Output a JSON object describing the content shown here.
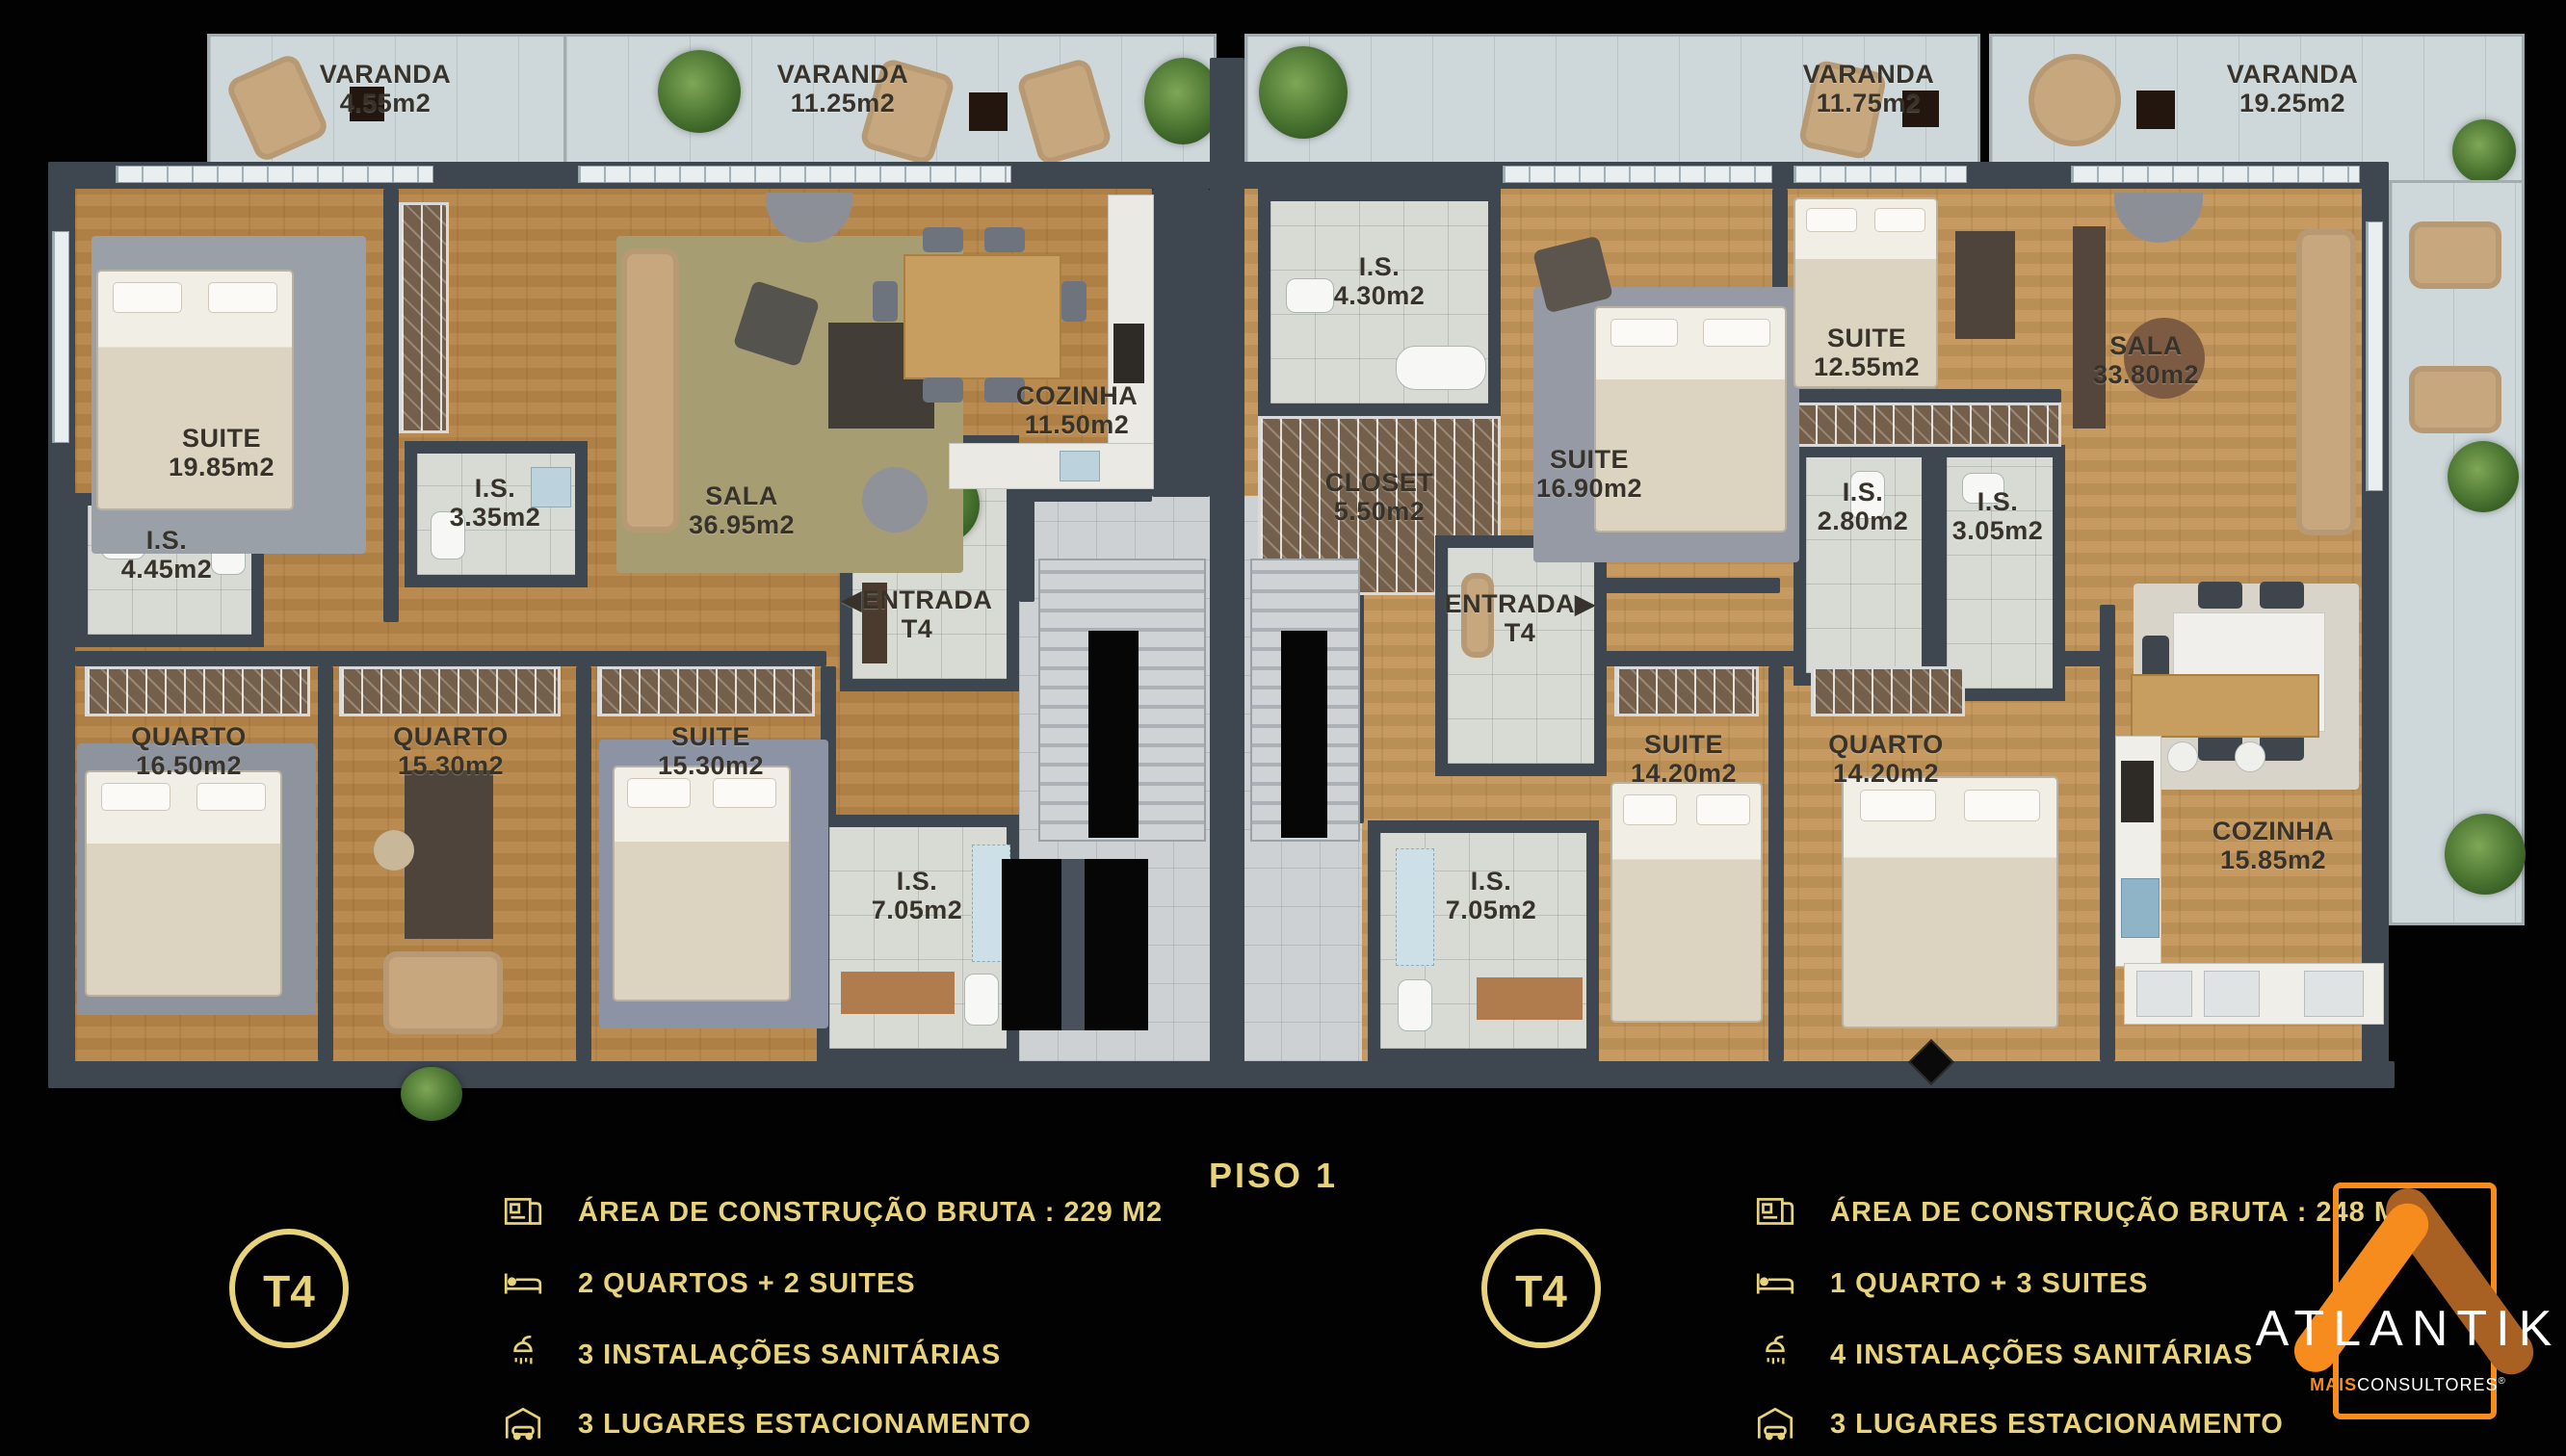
{
  "title": "PISO 1",
  "plan": {
    "entrance_arrow_left": "◀",
    "entrance_arrow_right": "▶",
    "rooms": [
      {
        "id": "varanda-a1",
        "name": "VARANDA",
        "area": "4.55m2"
      },
      {
        "id": "varanda-a2",
        "name": "VARANDA",
        "area": "11.25m2"
      },
      {
        "id": "suite-a1",
        "name": "SUITE",
        "area": "19.85m2"
      },
      {
        "id": "is-a1",
        "name": "I.S.",
        "area": "4.45m2"
      },
      {
        "id": "is-a2",
        "name": "I.S.",
        "area": "3.35m2"
      },
      {
        "id": "sala-a",
        "name": "SALA",
        "area": "36.95m2"
      },
      {
        "id": "cozinha-a",
        "name": "COZINHA",
        "area": "11.50m2"
      },
      {
        "id": "entrada-a",
        "name": "ENTRADA",
        "area": "T4"
      },
      {
        "id": "quarto-a1",
        "name": "QUARTO",
        "area": "16.50m2"
      },
      {
        "id": "quarto-a2",
        "name": "QUARTO",
        "area": "15.30m2"
      },
      {
        "id": "suite-a2",
        "name": "SUITE",
        "area": "15.30m2"
      },
      {
        "id": "is-a3",
        "name": "I.S.",
        "area": "7.05m2"
      },
      {
        "id": "is-b1",
        "name": "I.S.",
        "area": "4.30m2"
      },
      {
        "id": "closet-b",
        "name": "CLOSET",
        "area": "5.50m2"
      },
      {
        "id": "suite-b1",
        "name": "SUITE",
        "area": "16.90m2"
      },
      {
        "id": "suite-b2",
        "name": "SUITE",
        "area": "12.55m2"
      },
      {
        "id": "is-b2",
        "name": "I.S.",
        "area": "2.80m2"
      },
      {
        "id": "is-b3",
        "name": "I.S.",
        "area": "3.05m2"
      },
      {
        "id": "sala-b",
        "name": "SALA",
        "area": "33.80m2"
      },
      {
        "id": "varanda-b1",
        "name": "VARANDA",
        "area": "11.75m2"
      },
      {
        "id": "varanda-b2",
        "name": "VARANDA",
        "area": "19.25m2"
      },
      {
        "id": "entrada-b",
        "name": "ENTRADA",
        "area": "T4"
      },
      {
        "id": "suite-b3",
        "name": "SUITE",
        "area": "14.20m2"
      },
      {
        "id": "quarto-b1",
        "name": "QUARTO",
        "area": "14.20m2"
      },
      {
        "id": "is-b4",
        "name": "I.S.",
        "area": "7.05m2"
      },
      {
        "id": "cozinha-b",
        "name": "COZINHA",
        "area": "15.85m2"
      }
    ]
  },
  "units": [
    {
      "badge": "T4",
      "specs": [
        {
          "icon": "blueprint-icon",
          "label": "ÁREA DE CONSTRUÇÃO BRUTA :  229 M2"
        },
        {
          "icon": "bed-icon",
          "label": "2 QUARTOS + 2 SUITES"
        },
        {
          "icon": "shower-icon",
          "label": "3 INSTALAÇÕES SANITÁRIAS"
        },
        {
          "icon": "garage-icon",
          "label": "3 LUGARES ESTACIONAMENTO"
        }
      ]
    },
    {
      "badge": "T4",
      "specs": [
        {
          "icon": "blueprint-icon",
          "label": "ÁREA DE CONSTRUÇÃO BRUTA :  248 M2"
        },
        {
          "icon": "bed-icon",
          "label": "1 QUARTO + 3 SUITES"
        },
        {
          "icon": "shower-icon",
          "label": "4 INSTALAÇÕES SANITÁRIAS"
        },
        {
          "icon": "garage-icon",
          "label": "3 LUGARES ESTACIONAMENTO"
        }
      ]
    }
  ],
  "logo": {
    "brand": "ATLANTIK",
    "sub_bold": "MAIS",
    "sub_rest": "CONSULTORES",
    "registered": "®"
  },
  "colors": {
    "gold": "#E8D27A",
    "orange": "#F78C1E",
    "orange_dark": "#A96023",
    "wall": "#3E4650"
  }
}
